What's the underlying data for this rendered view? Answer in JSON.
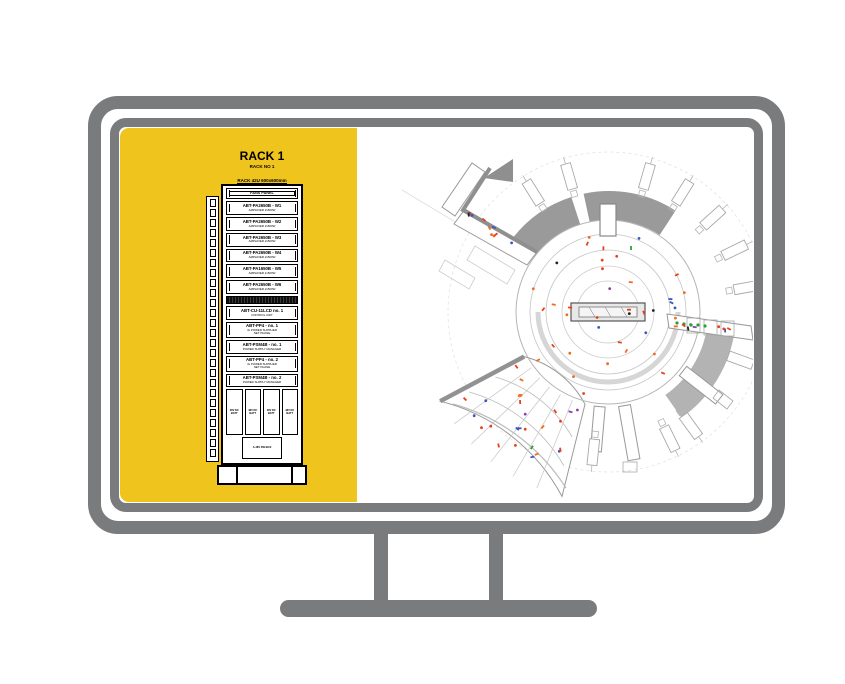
{
  "monitor": {
    "frame_color": "#7a7b7d",
    "screen_bg": "#ffffff"
  },
  "rack": {
    "panel_color": "#efc41c",
    "title": "RACK 1",
    "subtitle1": "RACK NO 1",
    "subtitle2": "RACK 42U 600x600mm",
    "ladder_slot_count": 26,
    "modules": [
      {
        "t": "fans",
        "label": "FANS PANEL"
      },
      {
        "t": "amp",
        "label": "ABT-PA2650B - W1",
        "sub": "AMPLIFIER 2x500W"
      },
      {
        "t": "amp",
        "label": "ABT-PA2650B - W2",
        "sub": "AMPLIFIER 2x500W"
      },
      {
        "t": "amp",
        "label": "ABT-PA2650B - W3",
        "sub": "AMPLIFIER 2x500W"
      },
      {
        "t": "amp",
        "label": "ABT-PA2650B - W4",
        "sub": "AMPLIFIER 2x500W"
      },
      {
        "t": "amp",
        "label": "ABT-PA1650B - W5",
        "sub": "AMPLIFIER 1x500W"
      },
      {
        "t": "amp",
        "label": "ABT-PA2650B - W6",
        "sub": "AMPLIFIER 2x500W"
      },
      {
        "t": "dark",
        "label": ""
      },
      {
        "t": "amp",
        "label": "ABT-CU-11LCD no. 1",
        "sub": "CONTROL UNIT"
      },
      {
        "t": "pp",
        "label": "ABT-PP4 - no. 1",
        "sub": "4x POWER SUPPLIER",
        "sub2": "NET PHASE"
      },
      {
        "t": "amp",
        "label": "ABT-PSM4B - no. 1",
        "sub": "POWER SUPPLY MANAGER"
      },
      {
        "t": "pp",
        "label": "ABT-PP4 - no. 2",
        "sub": "4x POWER SUPPLIER",
        "sub2": "NET PHASE"
      },
      {
        "t": "amp",
        "label": "ABT-PSM4B - no. 2",
        "sub": "POWER SUPPLY MANAGER"
      }
    ],
    "battery_labels": [
      "48V DC BATT",
      "48V DC BATT",
      "48V DC BATT",
      "48V DC BATT"
    ],
    "bottom_box_label": "A-48V SW BOX"
  },
  "floor_plan": {
    "line_color": "#9a9a9a",
    "roof_fill": "#9a9a9a",
    "markers": {
      "seed": 7,
      "colors": [
        "#e8401c",
        "#f06a20",
        "#3b55c0",
        "#2f9e38",
        "#8a3fa8",
        "#222222"
      ],
      "weights": [
        0.42,
        0.25,
        0.16,
        0.08,
        0.04,
        0.05
      ],
      "zones": [
        {
          "name": "hub",
          "count": 40
        },
        {
          "name": "corridor",
          "count": 10
        },
        {
          "name": "wing",
          "count": 26
        },
        {
          "name": "right-arm",
          "count": 8
        }
      ]
    }
  }
}
